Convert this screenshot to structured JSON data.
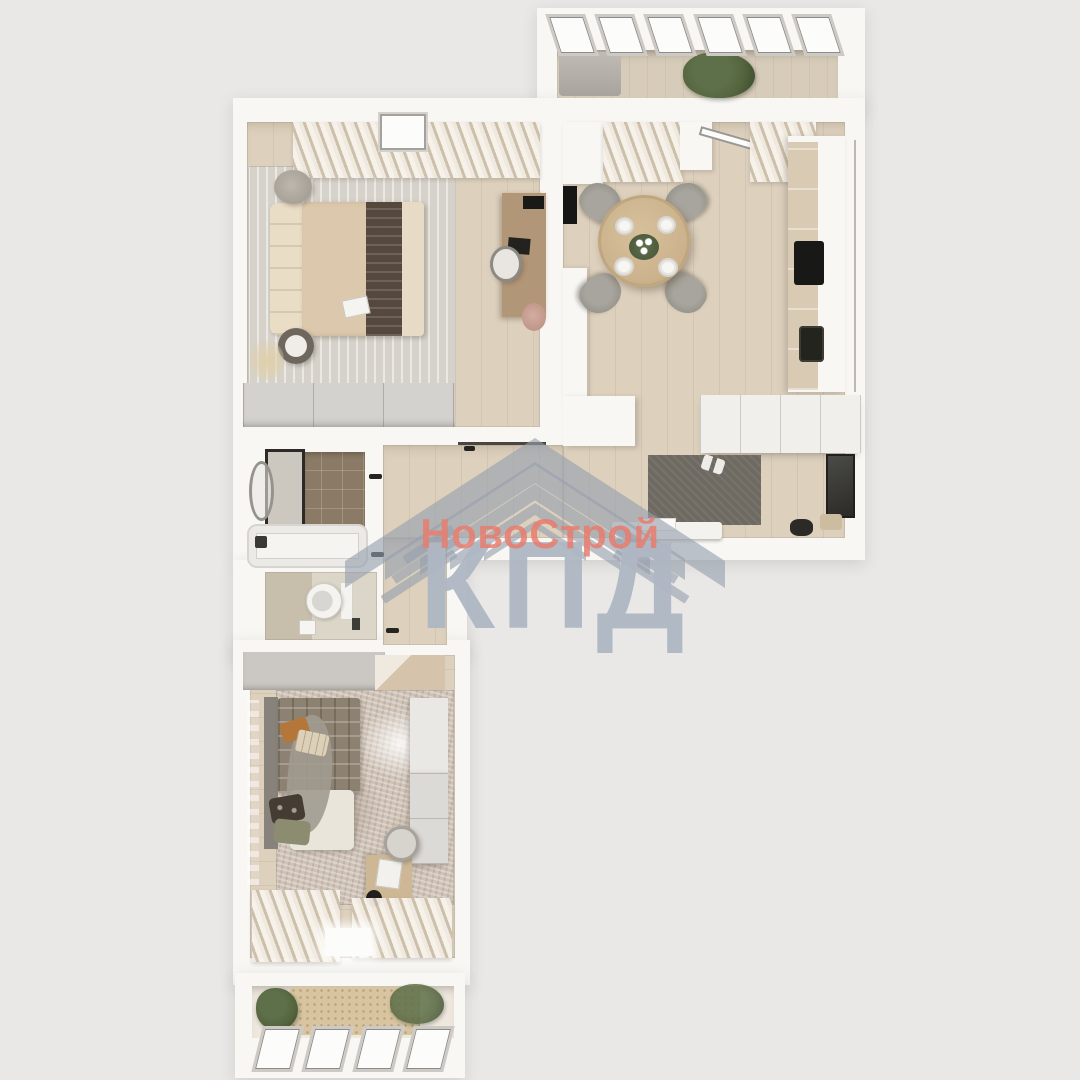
{
  "watermark": {
    "brand": "НовоСтрой",
    "logo_text": "КПД",
    "logo_icon": "roof-chevrons-icon"
  },
  "palette": {
    "background": "#e9e8e6",
    "wall": "#f8f7f4",
    "white": "#fcfcfb",
    "wood": "#ddd0bd",
    "rug_bedroom": "#d6d2ca",
    "bed": "#dcc9ad",
    "bed_runner": "#55493d",
    "pillow": "#e9ddc6",
    "wardrobe": "#d3d2ce",
    "desk_wood": "#b29678",
    "table_wood": "#cbb28c",
    "chair_gray": "#9a978f",
    "counter_wood": "#d8cab3",
    "hall_rug": "#6e6a62",
    "tile_brown": "#8b7b66",
    "plaid": "#8d8272",
    "rug2": "#cfc3b7",
    "mat": "#d8c5a0",
    "plant": "#55663f",
    "watermark_red": "#e87d6f",
    "watermark_gray": "#aeb7c3"
  }
}
